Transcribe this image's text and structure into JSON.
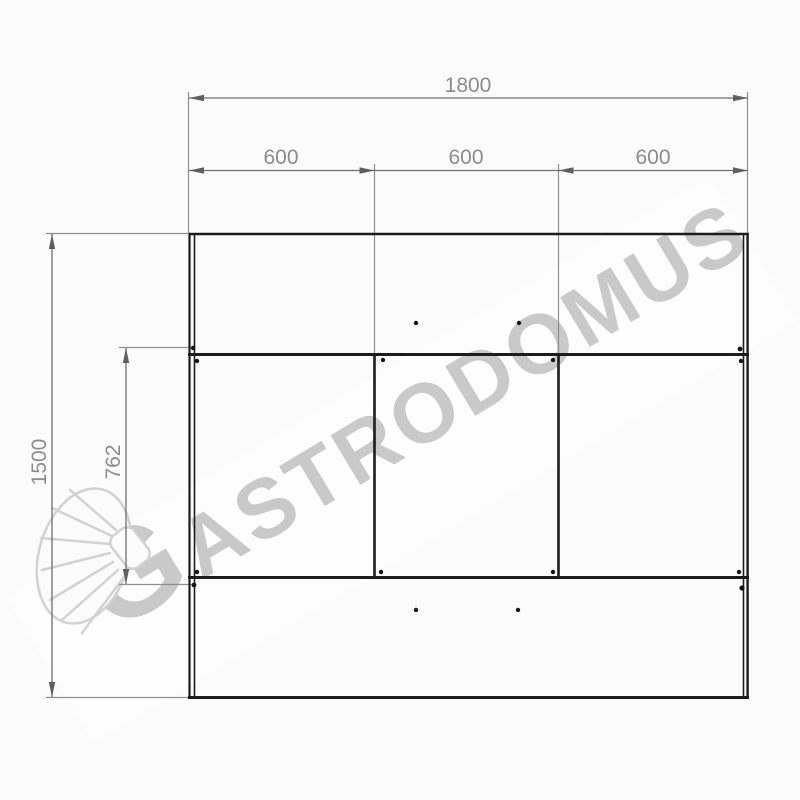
{
  "drawing": {
    "title": "cabinet-front-elevation",
    "dimensions": {
      "total_width": "1800",
      "sections": [
        "600",
        "600",
        "600"
      ],
      "total_height": "1500",
      "internal_height": "762"
    }
  },
  "watermark": {
    "brand": "GASTRODOMUS",
    "logo_initial": "G",
    "brand_rest": "ASTRODOMUS",
    "logo_icon": "chef-hat"
  },
  "colors": {
    "object_line": "#1c1c1c",
    "dimension_line": "#6e6e6e",
    "dimension_text": "#8c8c8c",
    "watermark_gray": "#c7c7c7",
    "background": "#fbfbfb"
  }
}
